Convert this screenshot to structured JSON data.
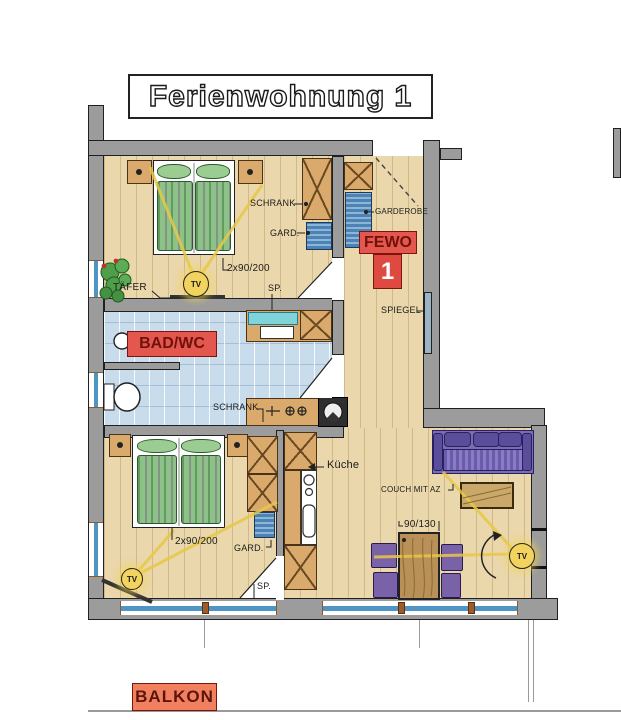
{
  "title": "Ferienwohnung 1",
  "colors": {
    "wood": "#ead7ab",
    "wall": "#9c9c9c",
    "tile": "#c8dcec",
    "bed": "#8cc287",
    "couch": "#7a6cb4",
    "cab": "#d9aa6b",
    "gard": "#5b8fc0",
    "tv": "#f2d35e",
    "red": "#e4574e",
    "balkon": "#f0805e",
    "win": "#4e94c4",
    "ink": "#1b1b1b"
  },
  "rooms": {
    "bedroom1": {
      "schrank_label": "SCHRANK",
      "gard_label": "GARD.",
      "bed_size": "2x90/200",
      "sp_label": "SP.",
      "taefer_label": "TÄFER",
      "tv_label": "TV"
    },
    "hall": {
      "garderobe_label": "GARDEROBE",
      "fewo_label": "FEWO",
      "fewo_number": "1",
      "spiegel_label": "SPIEGEL"
    },
    "bath": {
      "name_label": "BAD/WC",
      "schrank_label": "SCHRANK"
    },
    "bedroom2": {
      "bed_size": "2x90/200",
      "gard_label": "GARD.",
      "sp_label": "SP.",
      "tv_label": "TV"
    },
    "kitchen": {
      "name_label": "Küche"
    },
    "living": {
      "couch_label": "COUCH MIT AZ",
      "table_size": "90/130",
      "tv_label": "TV"
    },
    "balcony": {
      "name_label": "BALKON"
    }
  },
  "icons": {
    "tv-icon": "yellow circle marked TV",
    "plant-icon": "green plant with red blossoms",
    "toilet-icon": "toilet bowl",
    "washing-machine-icon": "dark square with drum circle",
    "sink-icon": "round basin",
    "lamp-icon": "bedside lamp dot",
    "door-swing-icon": "door leaf triangle",
    "valve-icon": "crossed-circle fittings"
  }
}
